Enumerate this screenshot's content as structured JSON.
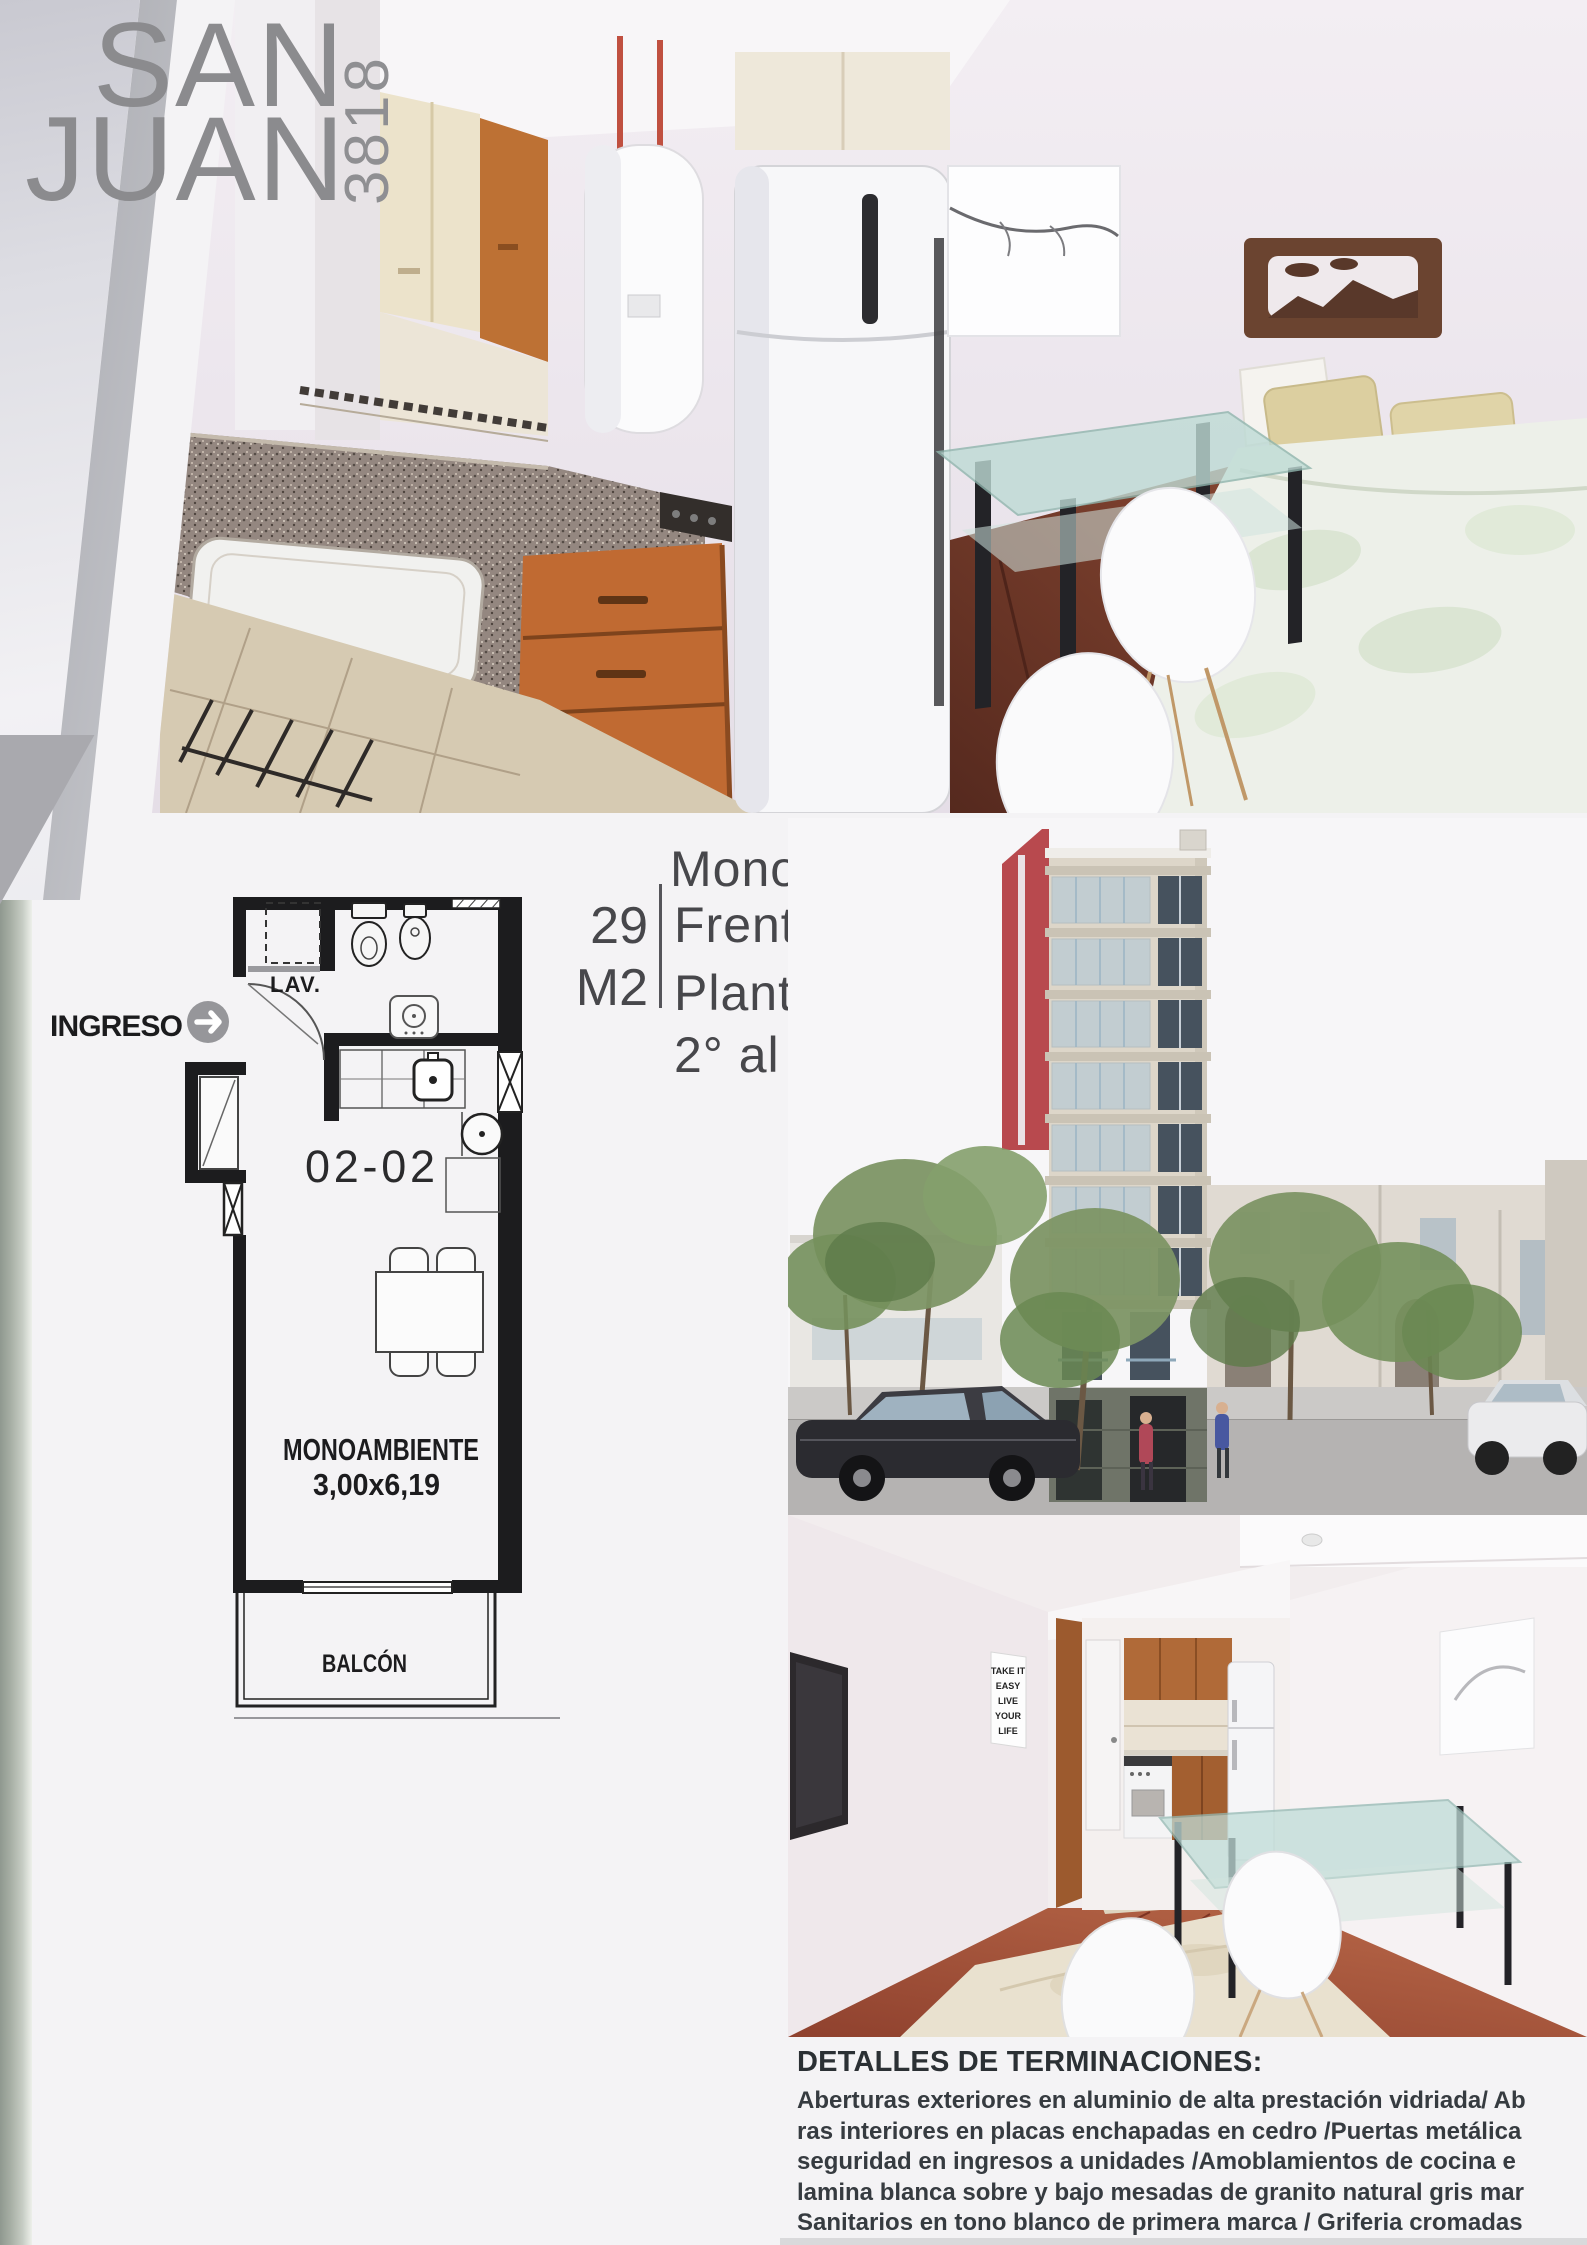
{
  "page": {
    "width": 1587,
    "height": 2245,
    "background": "#f4f3f5"
  },
  "logo": {
    "line1": "SAN",
    "line2": "JUAN",
    "number": "3818",
    "color": "#8b8b8e"
  },
  "unit_info": {
    "title": "Monoambiente",
    "area_value": "29",
    "area_unit": "M2",
    "facing": "Frente",
    "plan_type": "Planta Tipo",
    "floors_range": "2° al 5° Piso"
  },
  "floor_plan": {
    "entry_label": "INGRESO",
    "laundry_label": "LAV.",
    "unit_number": "02-02",
    "room_label": "MONOAMBIENTE",
    "room_size": "3,00x6,19",
    "balcony_label": "BALCÓN"
  },
  "poster": {
    "lines": [
      "TAKE IT",
      "EASY",
      "LIVE",
      "YOUR",
      "LIFE"
    ]
  },
  "details": {
    "heading": "DETALLES DE TERMINACIONES:",
    "lines": [
      "Aberturas exteriores en aluminio de alta prestación vidriada/ Ab",
      "ras interiores en placas enchapadas en cedro /Puertas metálica",
      "seguridad en ingresos a unidades /Amoblamientos de cocina e",
      "lamina blanca sobre y bajo mesadas de granito natural gris mar",
      "Sanitarios en tono blanco de primera marca / Griferia cromadas"
    ]
  },
  "colors": {
    "accent_red": "#b8494e",
    "plan_line": "#1c1c1e",
    "unit_text": "#47474b",
    "details_text": "#363b40",
    "sage_stripe": "#97a096",
    "wood": "#bf6f36",
    "glass": "#bcd9d4"
  }
}
